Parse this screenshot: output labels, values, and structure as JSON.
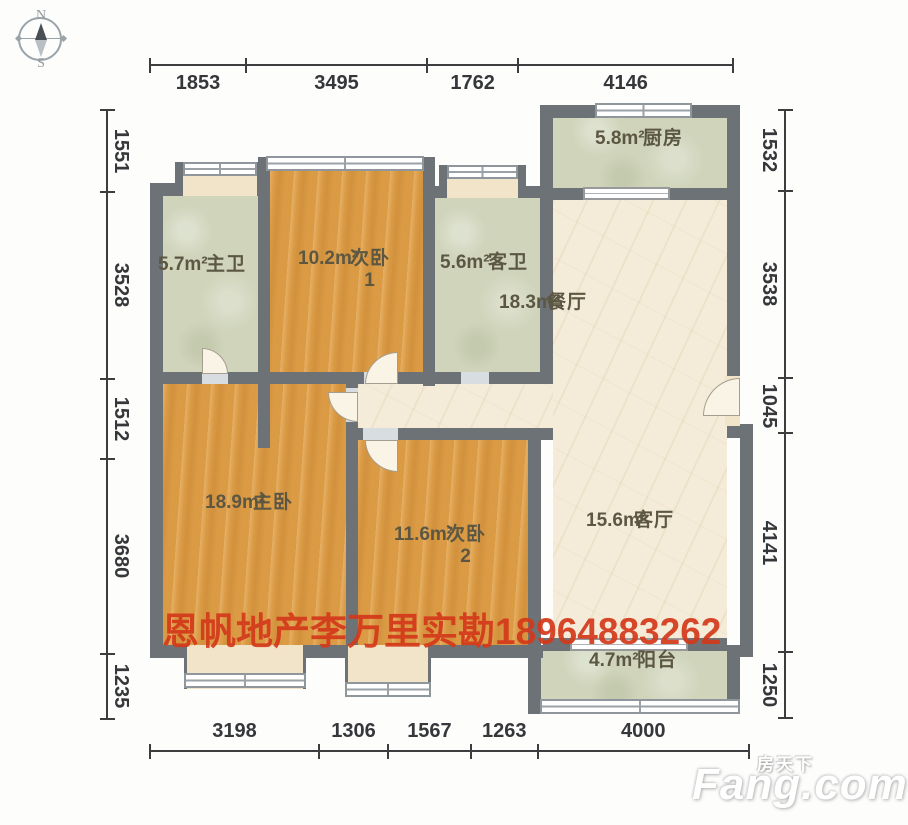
{
  "compass": {
    "north": "N",
    "south": "S"
  },
  "dimensions": {
    "top": [
      "1853",
      "3495",
      "1762",
      "4146"
    ],
    "bottom": [
      "3198",
      "1306",
      "1567",
      "1263",
      "4000"
    ],
    "left": [
      "1551",
      "3528",
      "1512",
      "3680",
      "1235"
    ],
    "right": [
      "1532",
      "3538",
      "1045",
      "4141",
      "1250"
    ]
  },
  "rooms": [
    {
      "id": "zhuwei",
      "name": "主卫",
      "area": "5.7m²"
    },
    {
      "id": "ciwo1",
      "name": "次卧1",
      "area": "10.2m²"
    },
    {
      "id": "kewei",
      "name": "客卫",
      "area": "5.6m²"
    },
    {
      "id": "chufang",
      "name": "厨房",
      "area": "5.8m²"
    },
    {
      "id": "canting",
      "name": "餐厅",
      "area": "18.3m²"
    },
    {
      "id": "zhuwo",
      "name": "主卧",
      "area": "18.9m²"
    },
    {
      "id": "ciwo2",
      "name": "次卧2",
      "area": "11.6m²"
    },
    {
      "id": "keting",
      "name": "客厅",
      "area": "15.6m²"
    },
    {
      "id": "yangtai",
      "name": "阳台",
      "area": "4.7m²"
    }
  ],
  "watermark": {
    "text": "恩帆地产李万里实勘18964883262",
    "color": "#d4391a"
  },
  "logo": {
    "cn": "房天下",
    "en": "Fang.com"
  },
  "colors": {
    "wall": "#6d7277",
    "wood": "#db9a44",
    "tile": "#cfd4ba",
    "marble": "#f4ecd9",
    "accent_red": "#d4391a"
  }
}
